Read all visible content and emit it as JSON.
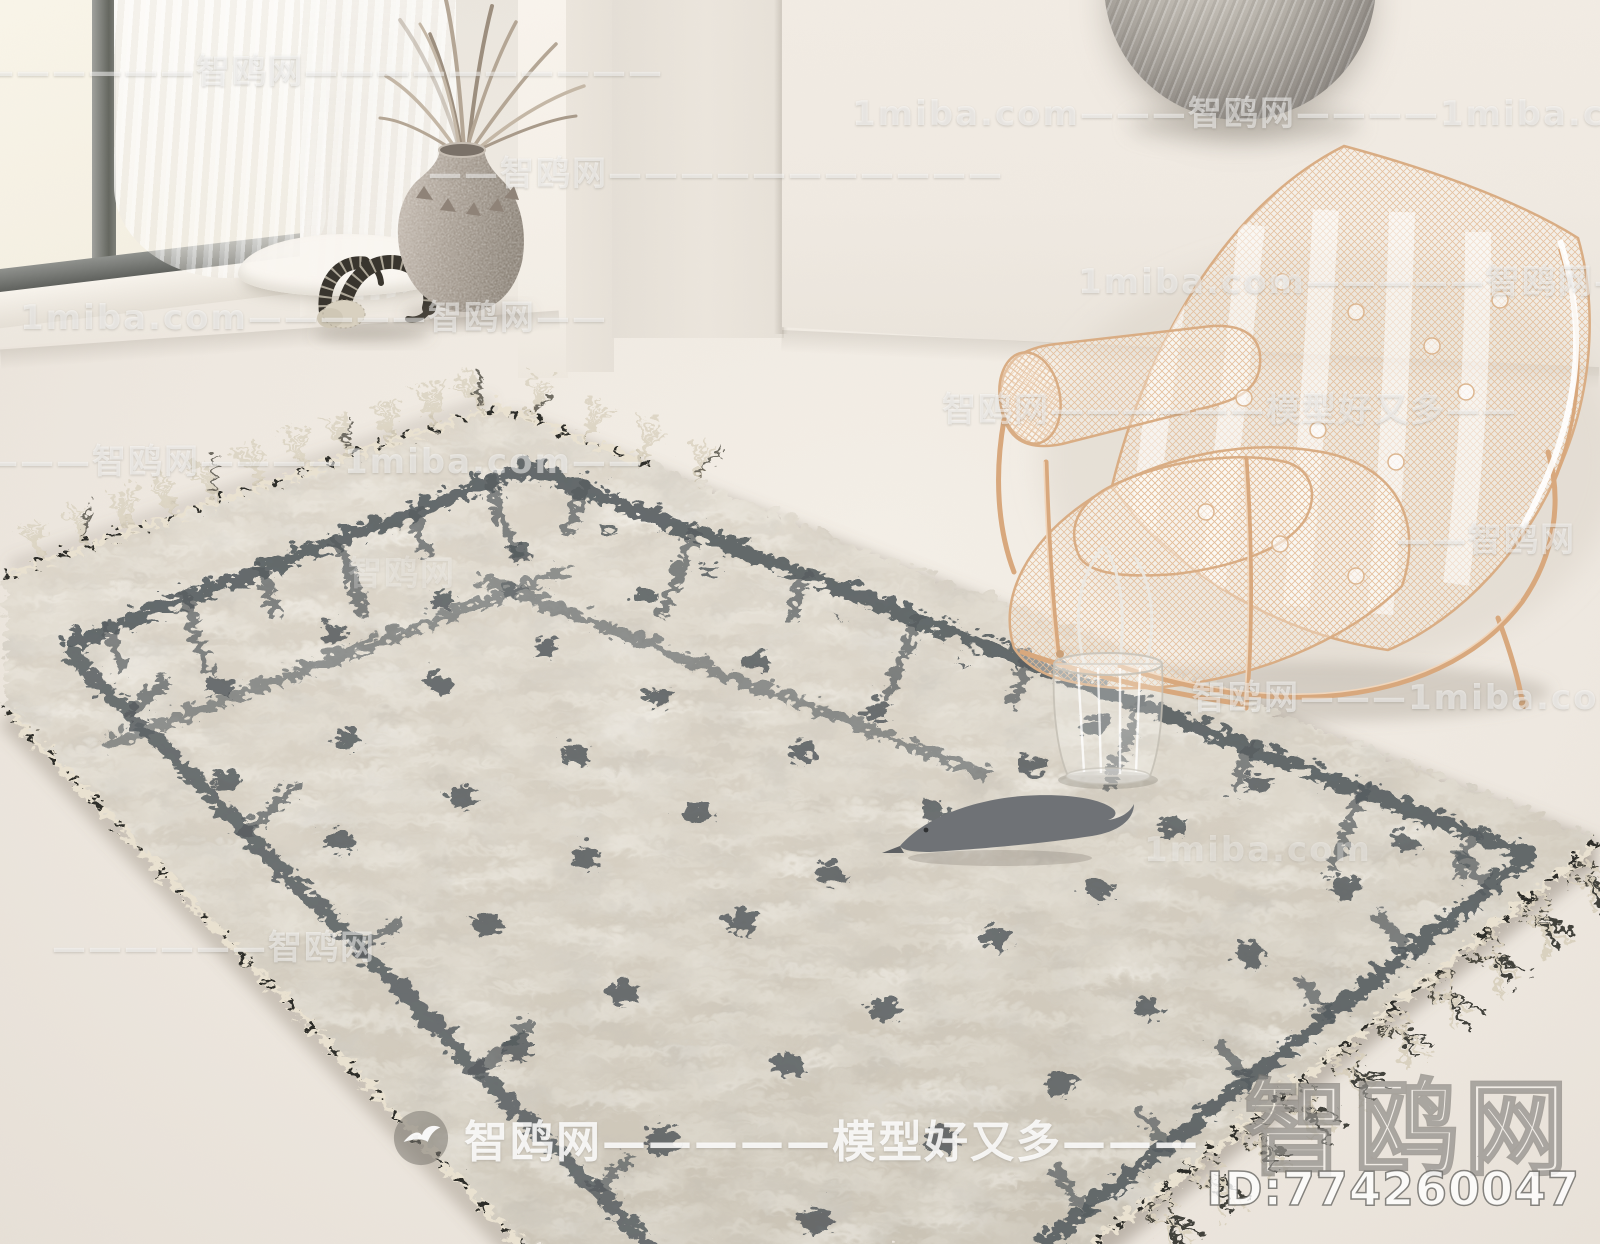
{
  "watermarks": {
    "brand": "智鸥网",
    "site": "1miba.com",
    "slogan": "模型好又多",
    "rows": [
      "——————智鸥网——————————",
      "1miba.com———智鸥网————1miba.com",
      "——智鸥网———————————",
      "1miba.com—————智鸥网—",
      "1miba.com—————智鸥网——",
      "智鸥网——————模型好又多——",
      "———智鸥网————1miba.com——",
      "智鸥网",
      "——智鸥网",
      "智鸥网———1miba.com",
      "1miba.com",
      "——————智鸥网"
    ],
    "footer": "智鸥网—————模型好又多———",
    "logo": "智鸥网",
    "model_id": "ID:774260047"
  },
  "books": {
    "top_spine": "ART HOUSE",
    "bottom_spine": "MONTBLANC",
    "magazine_edge_text": "MONTBLANC",
    "magazine_corner_text": "CO"
  },
  "colors": {
    "floor": "#efe9e1",
    "wall": "#ece7df",
    "window_frame": "#6f716e",
    "rug_base": "#d9d2c6",
    "rug_pattern": "#565c5f",
    "rug_trim": "#e8e0cf",
    "chair_copper": "#ddb38e",
    "metal_disc": "#a9a49c",
    "vase": "#a79d92",
    "bird_figurine": "#72757a"
  }
}
